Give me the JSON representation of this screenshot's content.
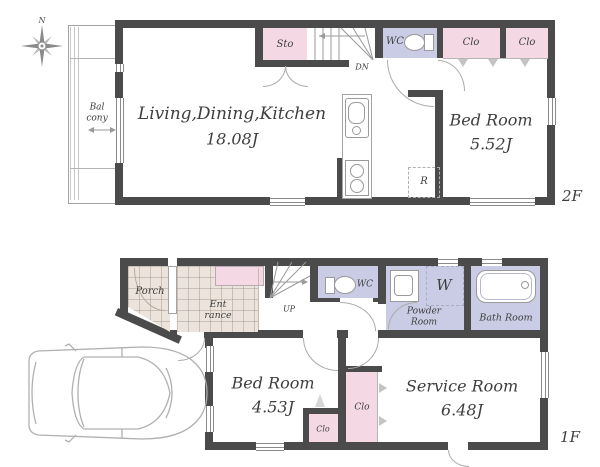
{
  "colors": {
    "wall": "#4b4b4b",
    "pink": "#f4d9e5",
    "lavender": "#c9cce4",
    "tile": "#ece4dc",
    "text": "#3e3e3e"
  },
  "compass": {
    "n": "N"
  },
  "f2": {
    "floor": "2F",
    "balcony_1": "Bal",
    "balcony_2": "cony",
    "ldk": "Living,Dining,Kitchen",
    "ldk_area": "18.08J",
    "sto": "Sto",
    "dn": "DN",
    "wc": "WC",
    "clo_1": "Clo",
    "clo_2": "Clo",
    "bedroom": "Bed Room",
    "bedroom_area": "5.52J",
    "fridge": "R"
  },
  "f1": {
    "floor": "1F",
    "porch": "Porch",
    "entrance_1": "Ent",
    "entrance_2": "rance",
    "up": "UP",
    "wc": "WC",
    "washer": "W",
    "powder_1": "Powder",
    "powder_2": "Room",
    "bath": "Bath Room",
    "bedroom": "Bed Room",
    "bedroom_area": "4.53J",
    "closet_bedroom": "Clo",
    "closet_service": "Clo",
    "service": "Service Room",
    "service_area": "6.48J"
  }
}
